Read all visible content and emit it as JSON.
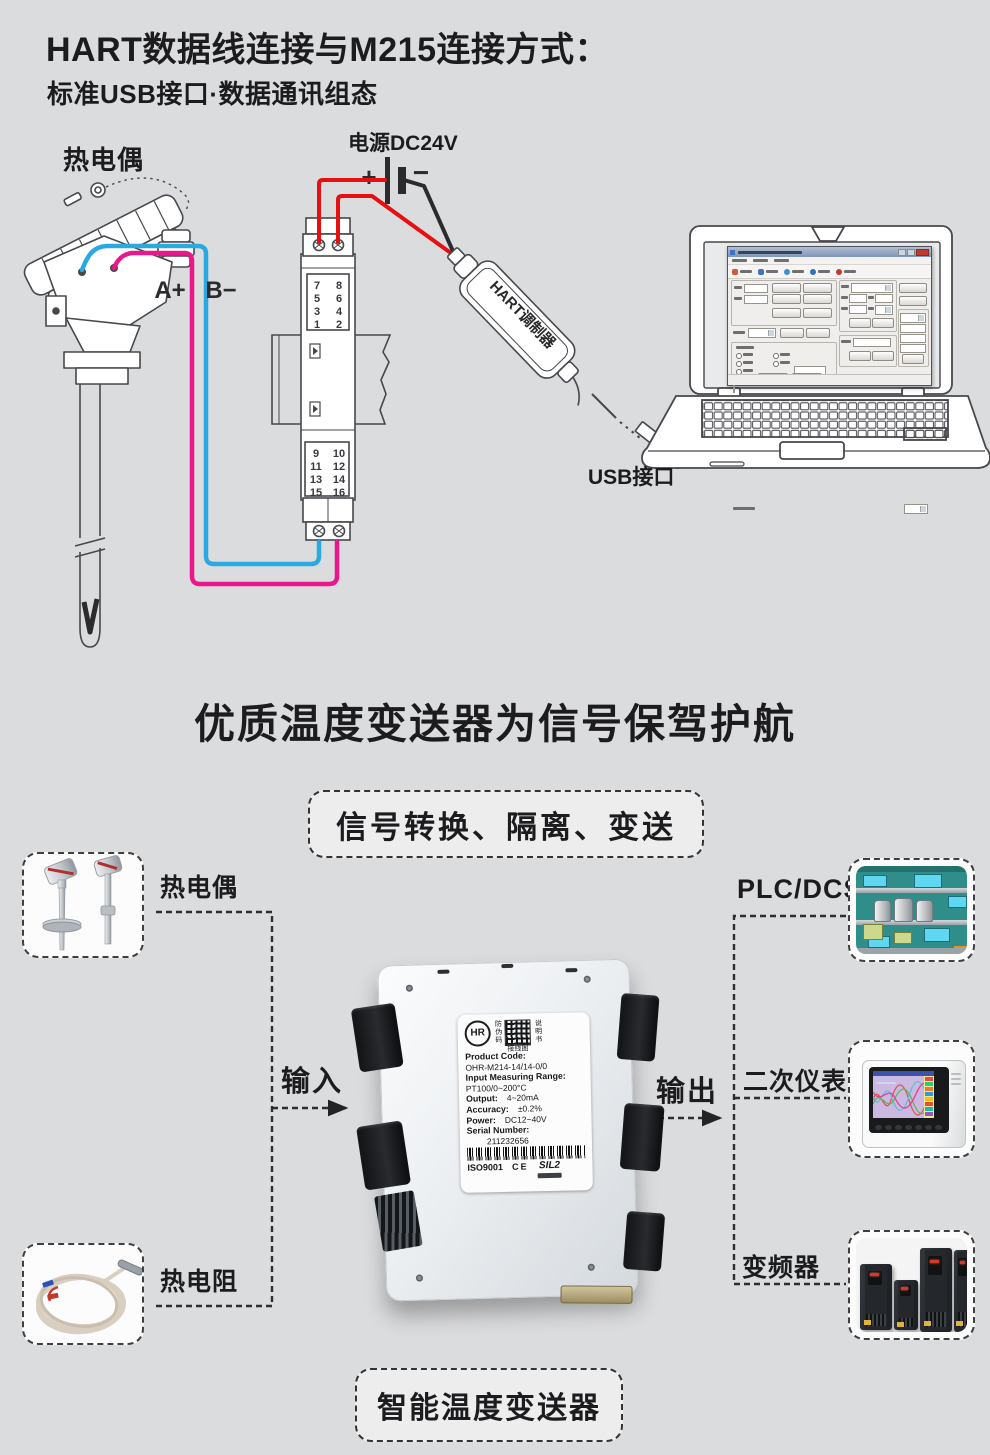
{
  "page": {
    "bg": "#dbdcde",
    "ink": "#1c1c1e"
  },
  "header": {
    "title": "HART数据线连接与M215连接方式：",
    "subtitle": "标准USB接口·数据通讯组态"
  },
  "diagram": {
    "tc_label": "热电偶",
    "power_label": "电源DC24V",
    "plus": "+",
    "minus": "−",
    "a_plus": "A+",
    "b_minus": "B−",
    "modulator": "HART调制器",
    "usb": "USB接口",
    "t_top": [
      [
        "7",
        "8"
      ],
      [
        "5",
        "6"
      ],
      [
        "3",
        "4"
      ],
      [
        "1",
        "2"
      ]
    ],
    "t_bot": [
      [
        "9",
        "10"
      ],
      [
        "11",
        "12"
      ],
      [
        "13",
        "14"
      ],
      [
        "15",
        "16"
      ]
    ],
    "wire_colors": {
      "red": "#e60f12",
      "blue": "#2aa9e0",
      "pink": "#ec168c",
      "black": "#2b2b2e"
    }
  },
  "slogan": "优质温度变送器为信号保驾护航",
  "banner": "信号转换、隔离、变送",
  "flow": {
    "input": "输入",
    "output": "输出",
    "left": [
      "热电偶",
      "热电阻"
    ],
    "right": [
      "PLC/DCS",
      "二次仪表",
      "变频器"
    ],
    "bottom": "智能温度变送器"
  },
  "pl": {
    "brand": "HR",
    "antifake": "防伪码",
    "manual": "说明书",
    "wiring": "接线图",
    "code_label": "Product Code:",
    "code": "OHR-M214-14/14-0/0",
    "range_label": "Input Measuring Range:",
    "range": "PT100/0~200°C",
    "output_label": "Output:",
    "output": "4~20mA",
    "acc_label": "Accuracy:",
    "acc": "±0.2%",
    "power_label": "Power:",
    "power": "DC12~40V",
    "serial_label": "Serial Number:",
    "serial": "211232656",
    "iso": "ISO9001",
    "ce": "CE",
    "sil": "SIL2"
  }
}
